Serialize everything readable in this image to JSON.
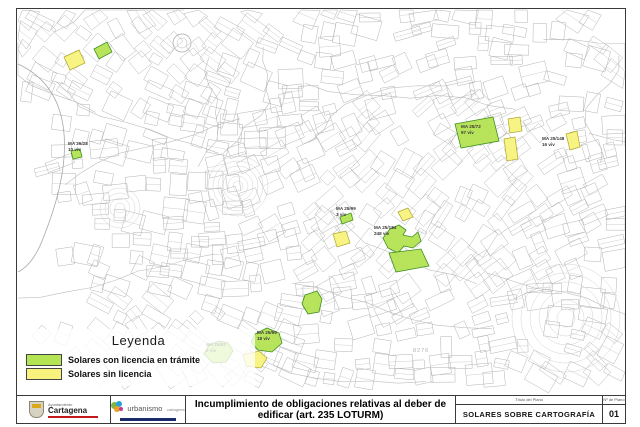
{
  "legend": {
    "title": "Leyenda",
    "items": [
      {
        "label": "Solares con licencia en trámite",
        "type": "green",
        "color": "#b4e353"
      },
      {
        "label": "Solares sin licencia",
        "type": "yellow",
        "color": "#f7f37d"
      }
    ]
  },
  "colors": {
    "green_fill": "#b4e353",
    "green_border": "#3f8f1f",
    "yellow_fill": "#f7f37d",
    "yellow_border": "#b0a62c",
    "map_line": "#b3b3b3",
    "accent_red": "#c41a1a",
    "accent_blue": "#1b2a6b"
  },
  "titleblock": {
    "org1_top": "Ayuntamiento",
    "org1_name": "Cartagena",
    "org2_name": "urbanismo",
    "org2_sub": "cartagena",
    "title_line1": "Incumplimiento de obligaciones relativas al deber de",
    "title_line2": "edificar (art. 235 LOTURM)",
    "plan_caption": "Título del Plano",
    "plan_title": "SOLARES SOBRE CARTOGRAFÍA",
    "number_caption": "Nº de Plano",
    "number": "01"
  },
  "map": {
    "ref_number": {
      "text": "8276",
      "x": 413,
      "y": 352
    },
    "plots": [
      {
        "id": "p1",
        "type": "yellow",
        "points": "64,57 79,50 85,63 70,70"
      },
      {
        "id": "p2",
        "type": "green",
        "points": "94,49 107,42 112,52 99,59"
      },
      {
        "id": "p3",
        "type": "green",
        "points": "71,151 80,149 82,157 73,159"
      },
      {
        "id": "p4",
        "type": "green",
        "points": "209,345 219,341 228,343 233,351 226,362 213,363 204,354"
      },
      {
        "id": "p5",
        "type": "green",
        "points": "255,334 267,328 279,333 282,343 272,352 258,350 251,342"
      },
      {
        "id": "p6",
        "type": "yellow",
        "points": "243,355 259,351 267,358 261,368 246,366"
      },
      {
        "id": "p7",
        "type": "yellow",
        "points": "333,234 346,231 350,243 337,247"
      },
      {
        "id": "p8",
        "type": "green",
        "points": "340,217 351,213 353,220 342,224"
      },
      {
        "id": "p9",
        "type": "green",
        "points": "390,229 399,225 406,230 403,235 412,237 418,232 421,241 413,248 404,246 398,253 388,248 383,238"
      },
      {
        "id": "p10",
        "type": "green",
        "points": "389,253 421,249 429,266 396,272"
      },
      {
        "id": "p11",
        "type": "yellow",
        "points": "398,212 408,208 413,217 403,221"
      },
      {
        "id": "p12",
        "type": "green",
        "points": "455,124 493,117 499,141 461,148"
      },
      {
        "id": "p13",
        "type": "yellow",
        "points": "508,119 520,117 522,131 510,133"
      },
      {
        "id": "p14",
        "type": "yellow",
        "points": "504,139 515,137 518,159 507,161"
      },
      {
        "id": "p15",
        "type": "yellow",
        "points": "566,134 577,131 580,147 570,150"
      },
      {
        "id": "p16",
        "type": "green",
        "points": "305,295 317,291 322,299 319,312 308,314 302,304"
      }
    ],
    "labels": [
      {
        "code": "MA 26/28",
        "units": "10 viv",
        "x": 68,
        "y": 145
      },
      {
        "code": "MA 25/63",
        "units": "2 viv",
        "x": 206,
        "y": 346
      },
      {
        "code": "MA 25/69",
        "units": "18 viv",
        "x": 257,
        "y": 334
      },
      {
        "code": "MA 25/99",
        "units": "3 viv",
        "x": 336,
        "y": 210
      },
      {
        "code": "MA 25/184",
        "units": "248 viv",
        "x": 374,
        "y": 229
      },
      {
        "code": "MA 25/72",
        "units": "97 viv",
        "x": 461,
        "y": 128
      },
      {
        "code": "MA 25/148",
        "units": "16 viv",
        "x": 542,
        "y": 140
      }
    ]
  }
}
